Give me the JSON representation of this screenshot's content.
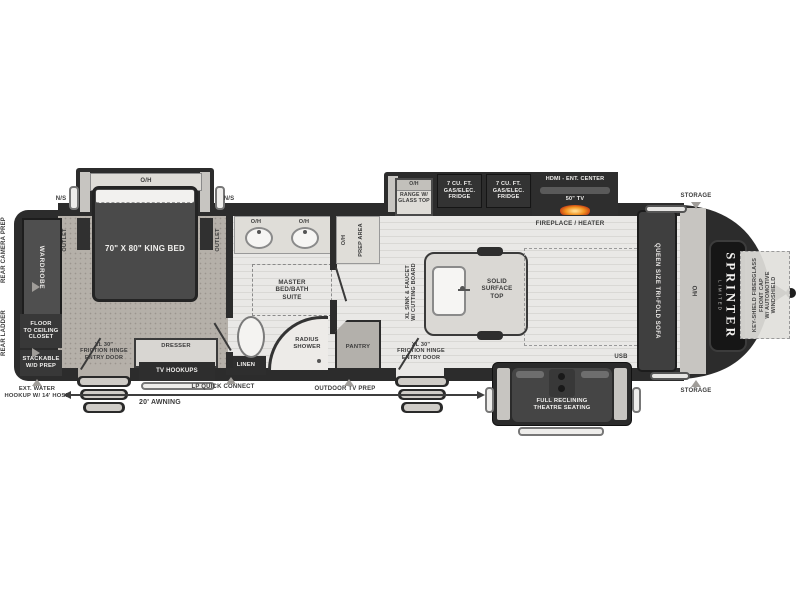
{
  "title": "Sprinter Limited fifth wheel RV floorplan",
  "colors": {
    "wall": "#2c2c2c",
    "carpet": "#b5b0a9",
    "wood_floor": "#e9e8e6",
    "slide_rail": "#c7c5c1",
    "flame_accent": "#f2921e"
  },
  "labels": {
    "oh": "O/H",
    "ns": "N/S",
    "outlet": "OUTLET",
    "king_bed": "70\" X 80\" KING BED",
    "wardrobe": "WARDROBE",
    "rear_camera": "REAR CAMERA PREP",
    "rear_ladder": "REAR LADDER",
    "closet": "FLOOR\nTO CEILING\nCLOSET",
    "wd": "STACKABLE\nW/D PREP",
    "ext_water": "EXT. WATER\nHOOKUP W/ 14' HOSE",
    "entry_door": "XL 30\"\nFRICTION HINGE\nENTRY DOOR",
    "dresser": "DRESSER",
    "tv_hookups": "TV HOOKUPS",
    "linen": "LINEN",
    "master": "MASTER\nBED/BATH\nSUITE",
    "shower": "RADIUS\nSHOWER",
    "pantry": "PANTRY",
    "prep_area": "PREP AREA",
    "range": "RANGE W/\nGLASS TOP",
    "fridge": "7 CU. FT.\nGAS/ELEC.\nFRIDGE",
    "hdmi": "HDMI - ENT. CENTER",
    "tv": "50\" TV",
    "fireplace": "FIREPLACE / HEATER",
    "xl_sink": "XL SINK & FAUCET\nW/ CUTTING BOARD",
    "solid_top": "SOLID\nSURFACE\nTOP",
    "lp": "LP QUICK CONNECT",
    "outdoor_tv": "OUTDOOR TV PREP",
    "awning": "20'  AWNING",
    "theatre": "FULL RECLINING\nTHEATRE SEATING",
    "usb": "USB",
    "sofa": "QUEEN SIZE TRI-FOLD SOFA",
    "storage": "STORAGE",
    "brand": "SPRINTER",
    "brand_tier": "LIMITED",
    "front_cap": "KEY-SHIELD FIBERGLASS\nFRONT CAP\nW/ AUTOMOTIVE\nWINDSHIELD"
  }
}
